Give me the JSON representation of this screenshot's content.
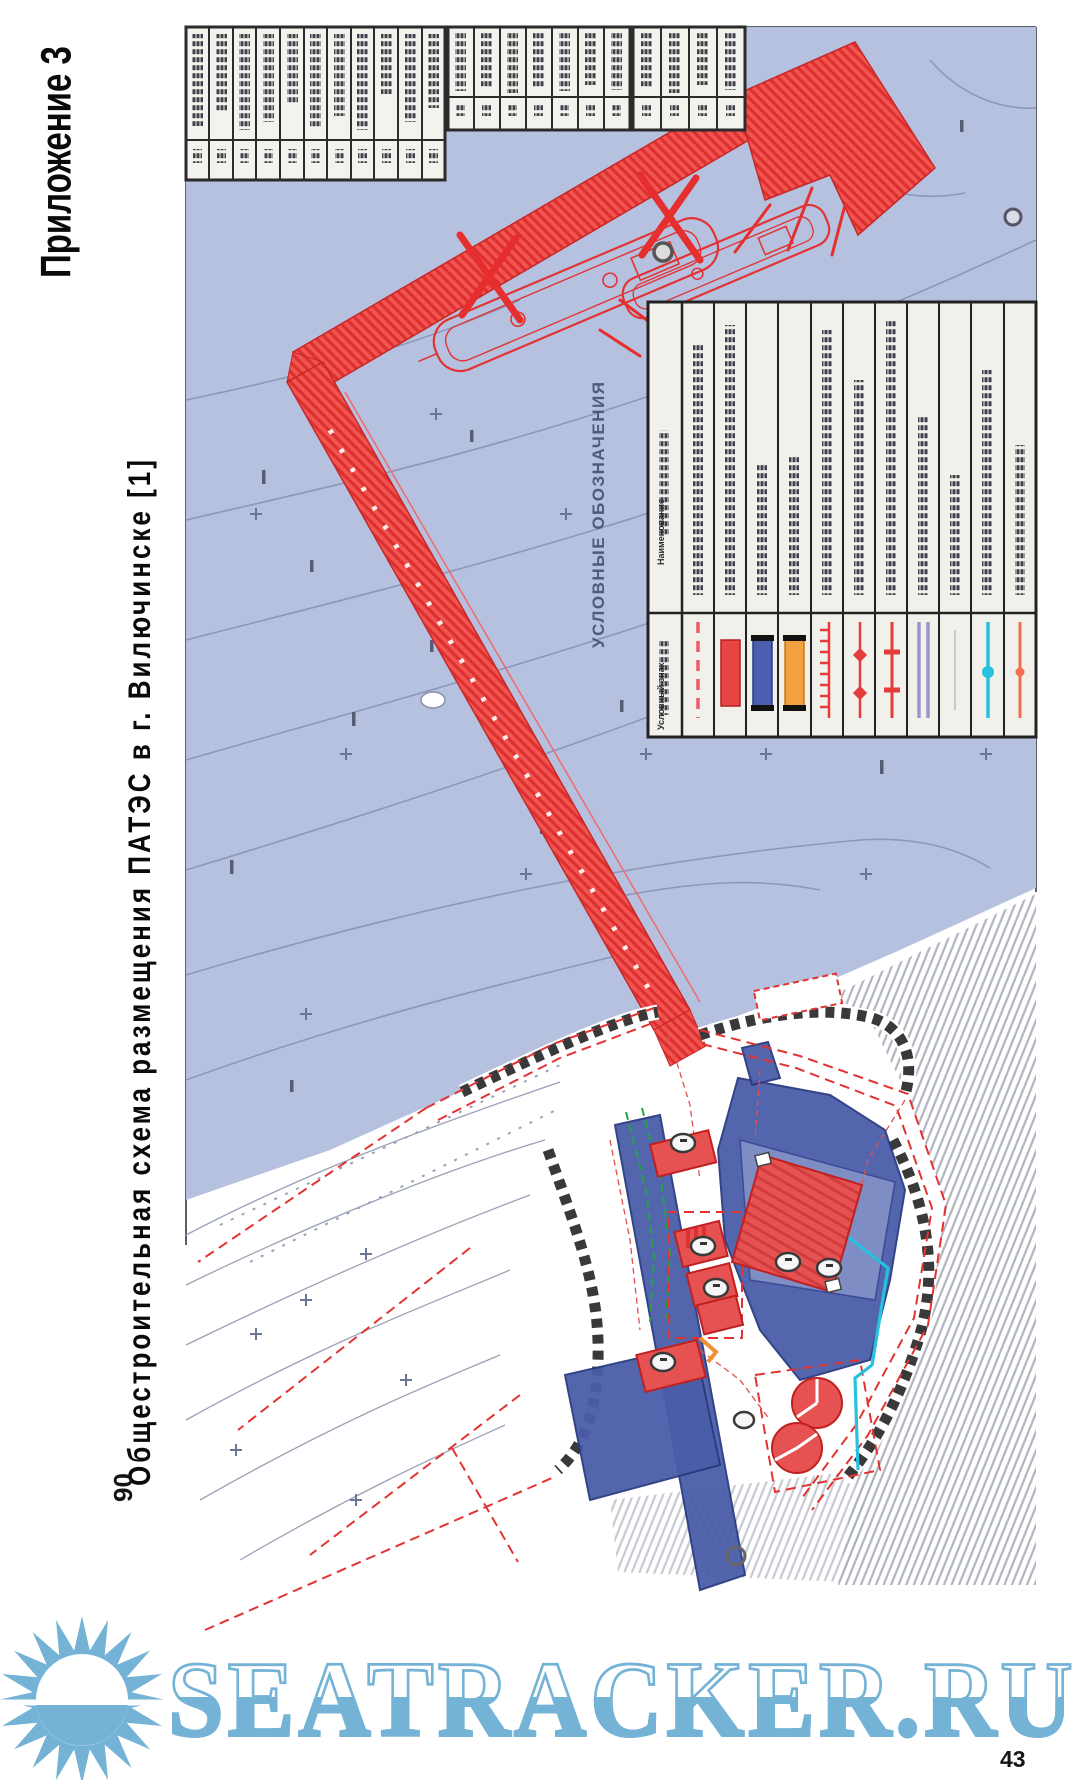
{
  "page": {
    "appendix_label": "Приложение 3",
    "title": "Общестроительная схема размещения ПАТЭС в г. Вилючинске [1]",
    "page_number": "43",
    "contour_elevation_label": "90"
  },
  "map": {
    "type": "general-construction-site-plan",
    "legend": {
      "title": "УСЛОВНЫЕ ОБОЗНАЧЕНИЯ",
      "header_symbol_column": "Условный знак",
      "header_name_column": "Наименование",
      "rows_count": 11,
      "labels_legible": false,
      "symbols": [
        "red-dashed-line",
        "red-solid-rect",
        "blue-solid-rect",
        "orange-solid-rect",
        "red-tick-line",
        "red-diamond-marker-line",
        "red-cross-marker-line",
        "purple-double-line",
        "empty",
        "cyan-line-with-dot",
        "orange-line-with-dot"
      ]
    },
    "schedule_tables": {
      "legible": false,
      "block_columns": [
        11,
        7,
        4
      ]
    },
    "features": [
      "hatched-red-pier-with-berthing-head",
      "floating-power-unit-ship-outlines",
      "mooring-dolphins",
      "depth-contours-in-water",
      "onshore-site-plan-with-buildings",
      "revetment-retaining-walls",
      "fuel-tanks",
      "terrain-slope-hatching"
    ],
    "colors": {
      "water": "#b6c1e0",
      "pier_red": "#ef4a44",
      "building_red": "#e65252",
      "paved_blue": "#4a5da8",
      "utility_cyan": "#25c1de",
      "orange": "#f2a040",
      "green": "#27a04a",
      "boundary_red": "#e23333",
      "contour_gray": "#8d97b8"
    }
  },
  "watermark": {
    "text": "SEATRACKER.RU",
    "emblem": "sun-over-water",
    "color": "#74b2d6"
  }
}
